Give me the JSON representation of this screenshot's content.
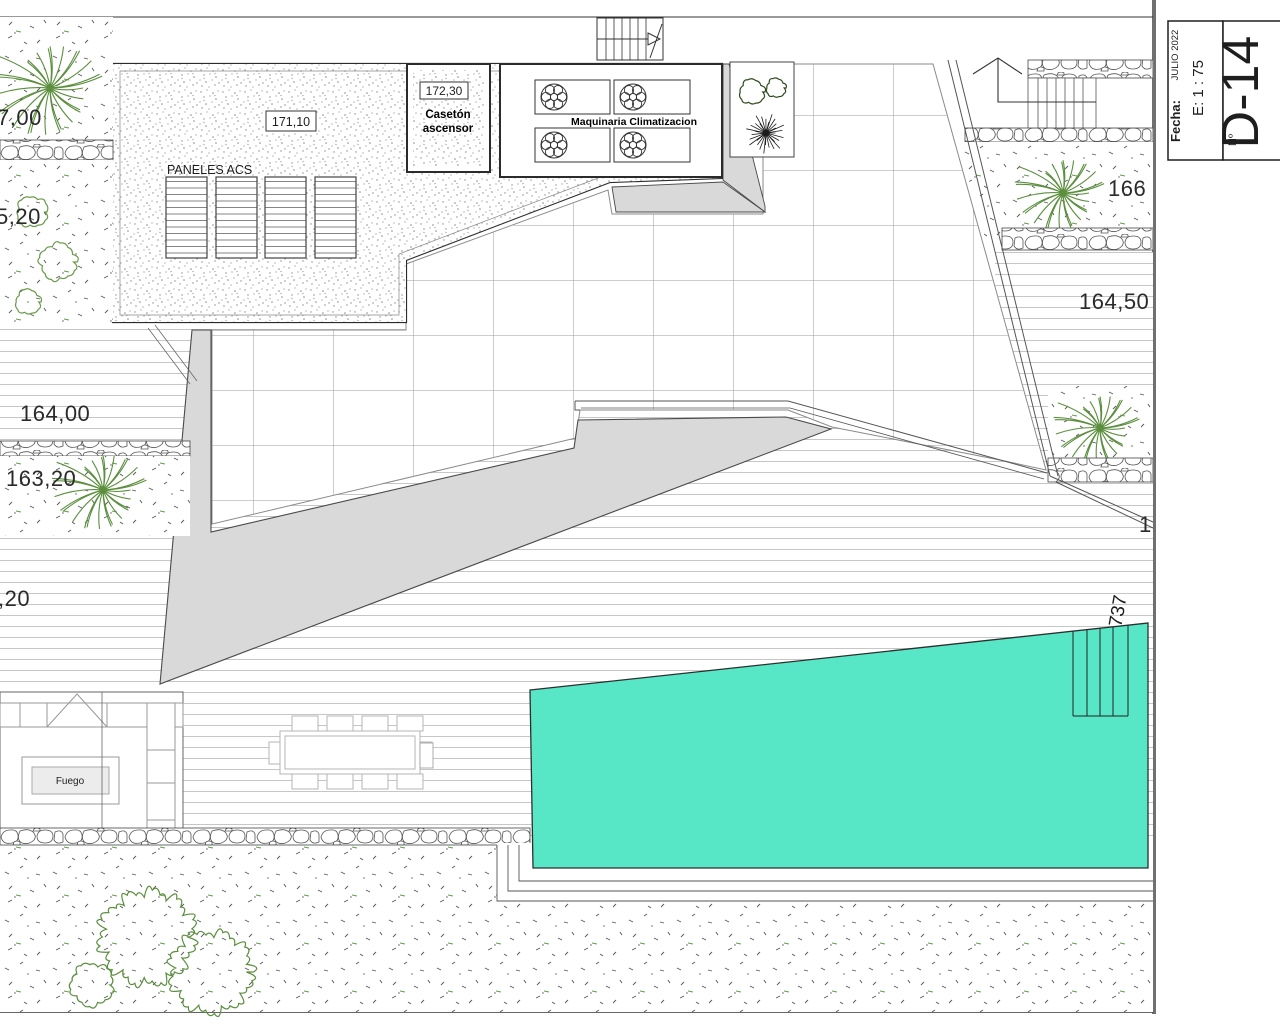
{
  "drawing": {
    "annotations": {
      "topleft_level": "7,00",
      "left_level_2": "5,20",
      "left_level_3": "164,00",
      "left_level_4": "163,20",
      "left_level_5": ",20",
      "right_level_1": "166",
      "right_level_2": "164,50",
      "right_level_3": "1",
      "pool_dim": "737",
      "roof_level": "171,10",
      "lift_level": "172,30",
      "lift_line1": "Casetón",
      "lift_line2": "ascensor",
      "machinery": "Maquinaria Climatizacion",
      "panels": "PANELES ACS",
      "fire": "Fuego"
    },
    "title_block": {
      "date_label": "Fecha:",
      "date": "JULIO 2022",
      "scale": "E: 1 : 75",
      "sheet_label": "Nº",
      "sheet": "D-14"
    },
    "colors": {
      "pool": "#58E7C6",
      "shade": "#D9D9D9",
      "plant_green": "#5B8F3E"
    }
  }
}
